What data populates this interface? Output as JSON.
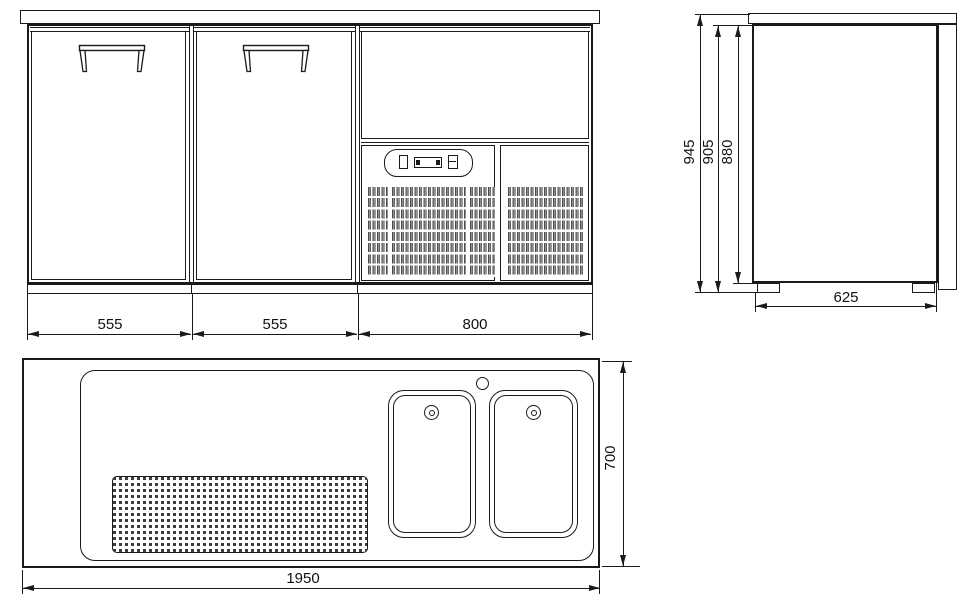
{
  "drawing": {
    "type": "technical-three-view-drawing",
    "subject": "refrigerated bar counter with two doors, machine compartment and double sink top",
    "views": {
      "front": {
        "label": "front view",
        "dim_door_left": "555",
        "dim_door_right": "555",
        "dim_machine_section": "800"
      },
      "side": {
        "label": "side view",
        "dim_overall_height": "945",
        "dim_height_under_top": "905",
        "dim_body_height": "880",
        "dim_depth": "625"
      },
      "top": {
        "label": "plan view",
        "dim_overall_width": "1950",
        "dim_overall_depth": "700"
      }
    },
    "colors": {
      "line": "#1a1a1a",
      "background": "#ffffff",
      "grille": "#4d4d4d"
    }
  }
}
